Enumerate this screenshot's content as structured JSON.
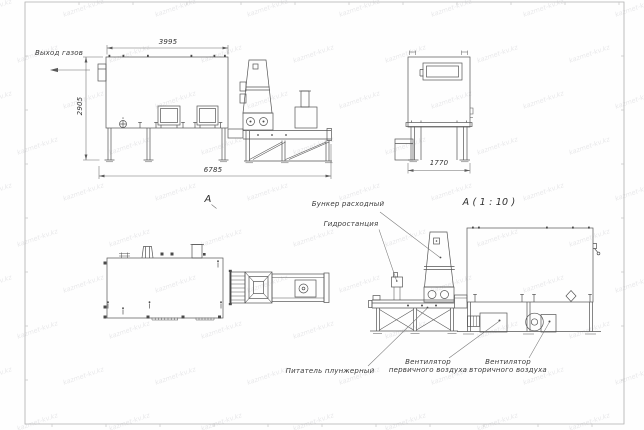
{
  "watermark": {
    "text": "kazmet-kv.kz"
  },
  "labels": {
    "gas_outlet": "Выход газов",
    "view_a": "А",
    "view_a_scale": "А ( 1 : 10 )",
    "hopper": "Бункер расходный",
    "hydraulic_station": "Гидростанция",
    "feeder": "Питатель плунжерный",
    "fan_primary_l1": "Вентилятор",
    "fan_primary_l2": "первичного воздуха",
    "fan_secondary_l1": "Вентилятор",
    "fan_secondary_l2": "вторичного воздуха"
  },
  "dimensions": {
    "top_width": "3995",
    "left_height": "2905",
    "bottom_width": "6785",
    "front_width": "1770"
  }
}
